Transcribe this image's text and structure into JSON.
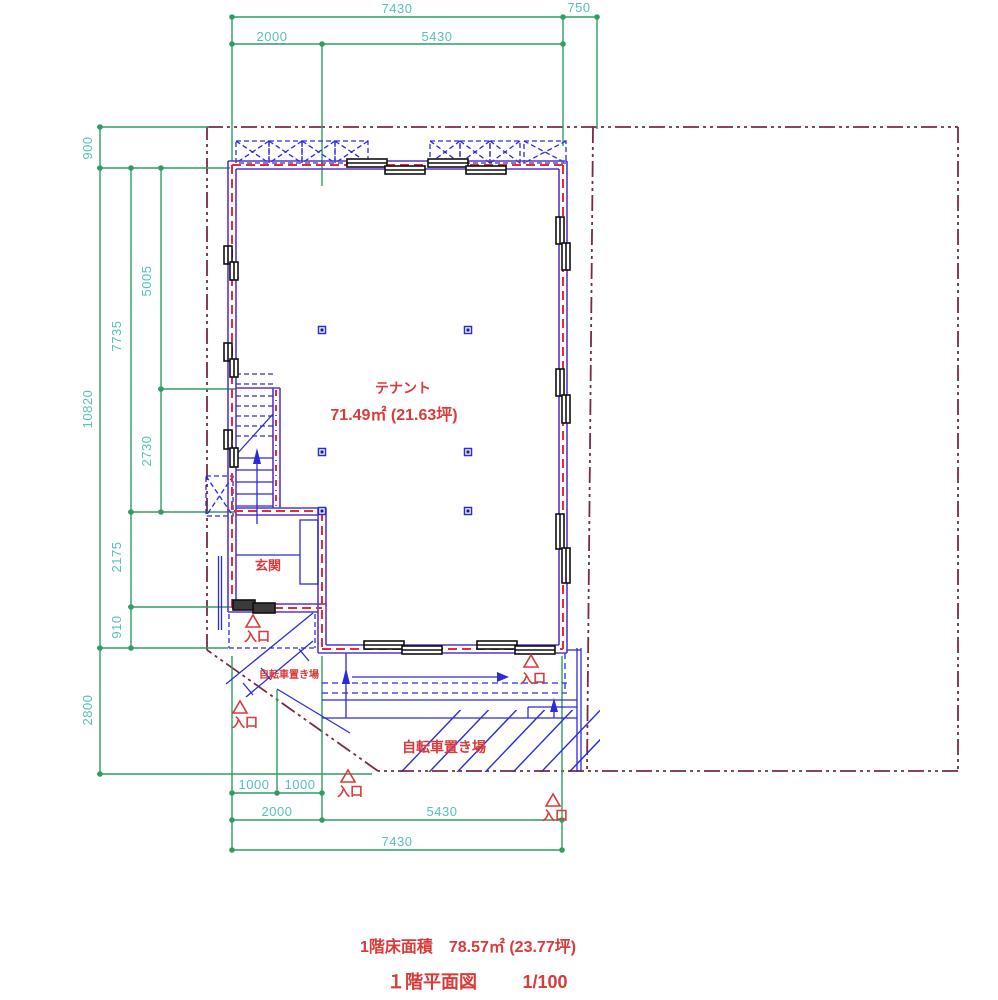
{
  "drawing": {
    "type": "architectural-floor-plan",
    "floor": "1F"
  },
  "dimensions": {
    "top": [
      "7430",
      "750",
      "2000",
      "5430"
    ],
    "left": [
      "900",
      "5005",
      "7735",
      "10820",
      "2730",
      "2175",
      "910",
      "2800"
    ],
    "bottom": [
      "1000",
      "1000",
      "2000",
      "5430",
      "7430"
    ]
  },
  "labels": {
    "tenant": "テナント",
    "tenant_area": "71.49㎡ (21.63坪)",
    "genkan": "玄関",
    "entrance": "入口",
    "bicycle": "自転車置き場"
  },
  "footer": {
    "floor_area": "1階床面積　78.57㎡ (23.77坪)",
    "plan_title": "１階平面図",
    "scale": "1/100"
  },
  "colors": {
    "dimension_line": "#2f9e62",
    "dimension_text": "#55c2b8",
    "wall": "#5a35c8",
    "wall_core_dash": "#e03030",
    "detail_blue": "#2b2bdd",
    "boundary": "#7a2b40",
    "label_red": "#d93a3a",
    "window": "#111111"
  }
}
